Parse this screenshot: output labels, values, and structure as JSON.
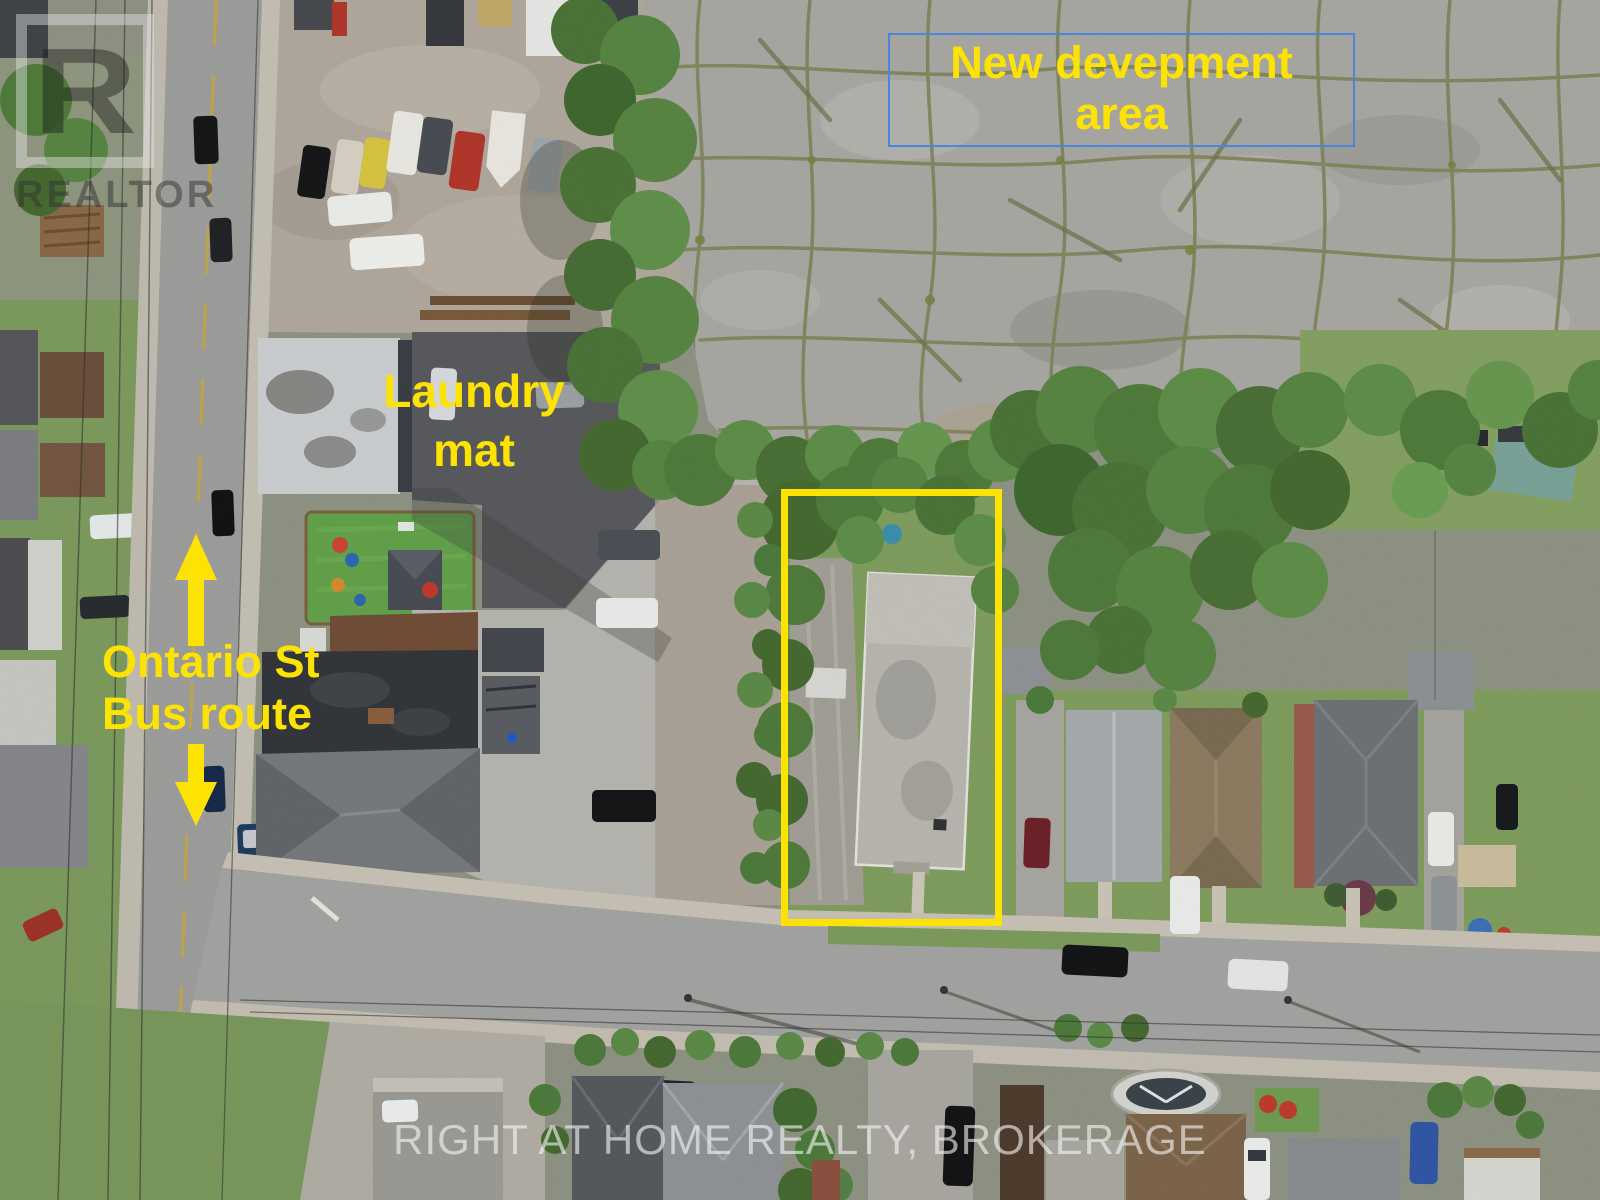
{
  "annotations": {
    "development_area": {
      "label": "New devepment\narea"
    },
    "laundromat": {
      "label": "Laundry\nmat"
    },
    "bus_route": {
      "label": "Ontario St\nBus route"
    }
  },
  "watermarks": {
    "realtor_letter": "R",
    "realtor_word": "REALTOR",
    "brokerage": "RIGHT AT HOME REALTY, BROKERAGE"
  },
  "colors": {
    "annotation_yellow": "#fde303",
    "development_box_blue": "#4a86e0",
    "watermark_white": "#f8f8f8"
  }
}
